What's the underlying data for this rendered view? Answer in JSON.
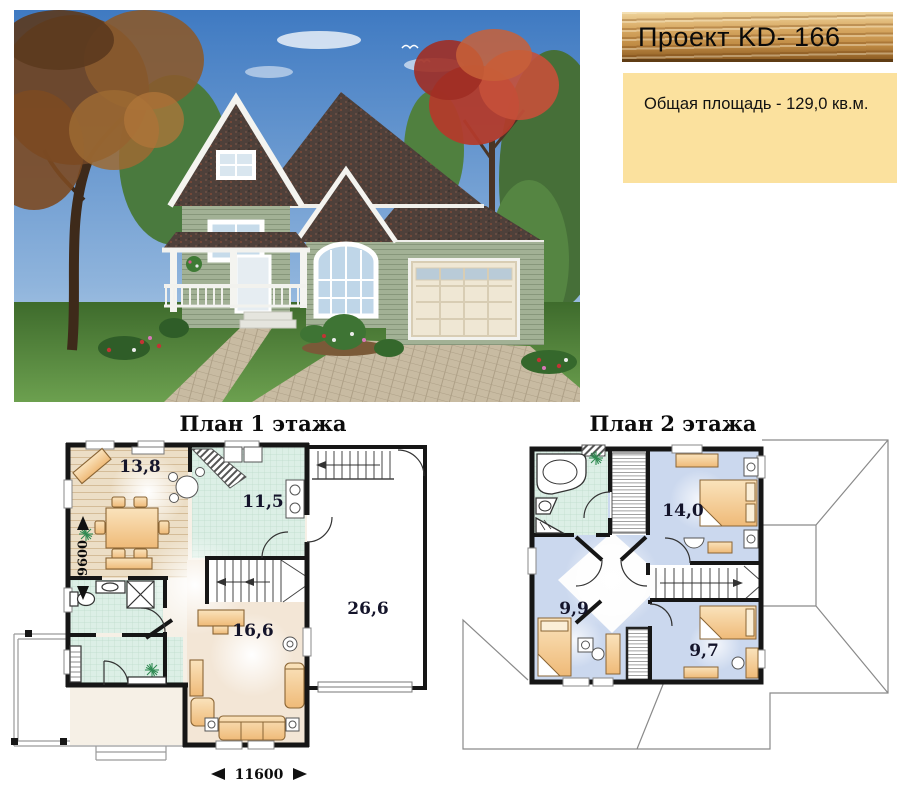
{
  "header": {
    "title": "Проект KD- 166"
  },
  "info": {
    "total_area": "Общая площадь -  129,0 кв.м."
  },
  "floor1": {
    "title": "План 1 этажа",
    "rooms": {
      "dining": "13,8",
      "kitchen": "11,5",
      "garage": "26,6",
      "living": "16,6"
    },
    "dims": {
      "depth": "9600",
      "width": "11600"
    }
  },
  "floor2": {
    "title": "План 2 этажа",
    "rooms": {
      "bedroom1": "14,0",
      "bedroom2": "9,9",
      "bedroom3": "9,7"
    }
  },
  "colors": {
    "banner_wood": "#C99552",
    "info_cream": "#FBE19E",
    "floor_wood": "#ECDEC6",
    "floor_tile": "#DCEFE6",
    "floor_blue": "#CBD8EE",
    "floor_beige": "#F3E6D6",
    "furniture": "#F3C88A",
    "wall": "#161616",
    "roofline": "#8A8A8A"
  }
}
